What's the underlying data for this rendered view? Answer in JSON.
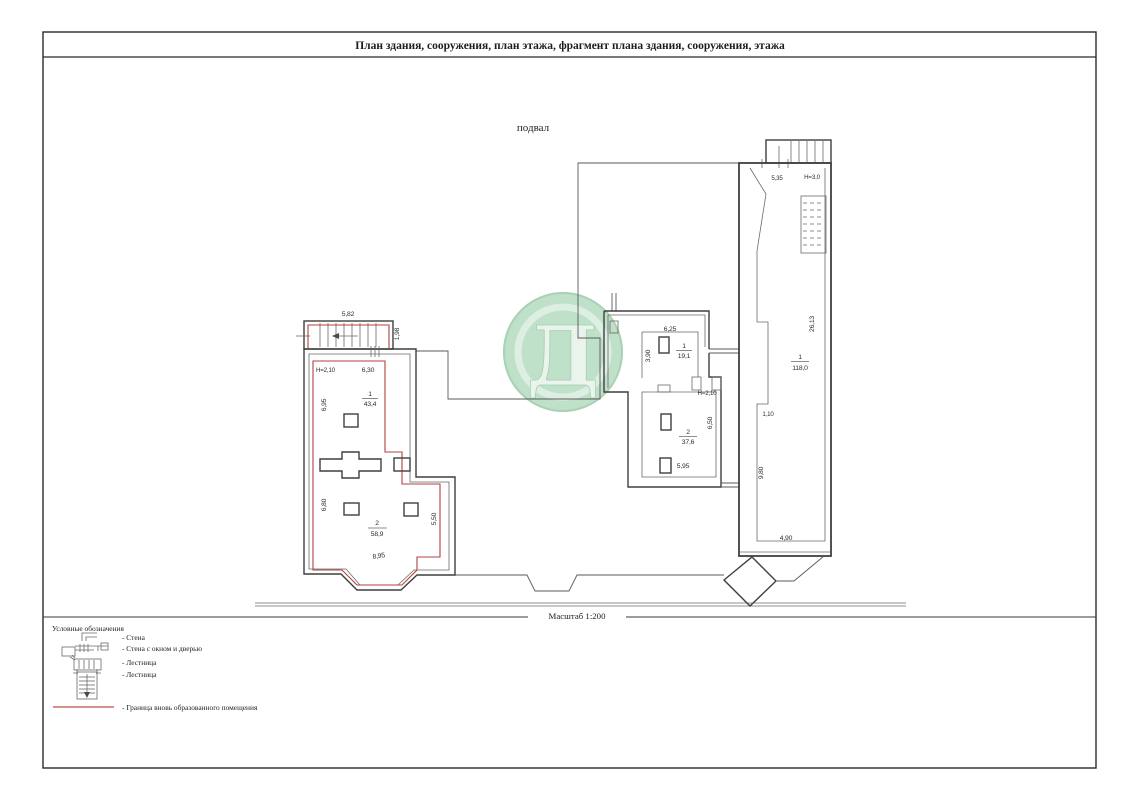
{
  "page": {
    "title": "План здания, сооружения, план этажа, фрагмент плана здания, сооружения, этажа",
    "floor_label": "подвал",
    "scale_label": "Масштаб 1:200"
  },
  "left_plan": {
    "dim_top": "5,82",
    "dim_right_top": "1,98",
    "height_label": "H=2,10",
    "dim_630": "6,30",
    "dim_695": "6,95",
    "dim_680": "6,80",
    "dim_550": "5,50",
    "dim_895": "8,95",
    "rooms": [
      {
        "num": "1",
        "area": "43,4"
      },
      {
        "num": "2",
        "area": "58,9"
      }
    ]
  },
  "middle_plan": {
    "dim_625": "6,25",
    "dim_390": "3,90",
    "height_label": "H=2,10",
    "dim_650": "6,50",
    "dim_595": "5,95",
    "rooms": [
      {
        "num": "1",
        "area": "19,1"
      },
      {
        "num": "2",
        "area": "37,6"
      }
    ]
  },
  "right_plan": {
    "dim_535": "5,35",
    "height_label": "H=3,0",
    "dim_2613": "26,13",
    "dim_110": "1,10",
    "dim_980": "9,80",
    "dim_490": "4,90",
    "rooms": [
      {
        "num": "1",
        "area": "118,0"
      }
    ]
  },
  "legend": {
    "title": "Условные обозначения",
    "items": [
      {
        "label": "- Стена"
      },
      {
        "label": "- Стена с окном и дверью"
      },
      {
        "label": "- Лестница"
      },
      {
        "label": "- Лестница"
      },
      {
        "label": "- Граница вновь образованного помещения"
      }
    ]
  },
  "watermark": {
    "letter": "Д"
  },
  "colors": {
    "line": "#3f3f3f",
    "red": "#b2423c",
    "watermark_green": "#bcdfc7"
  }
}
